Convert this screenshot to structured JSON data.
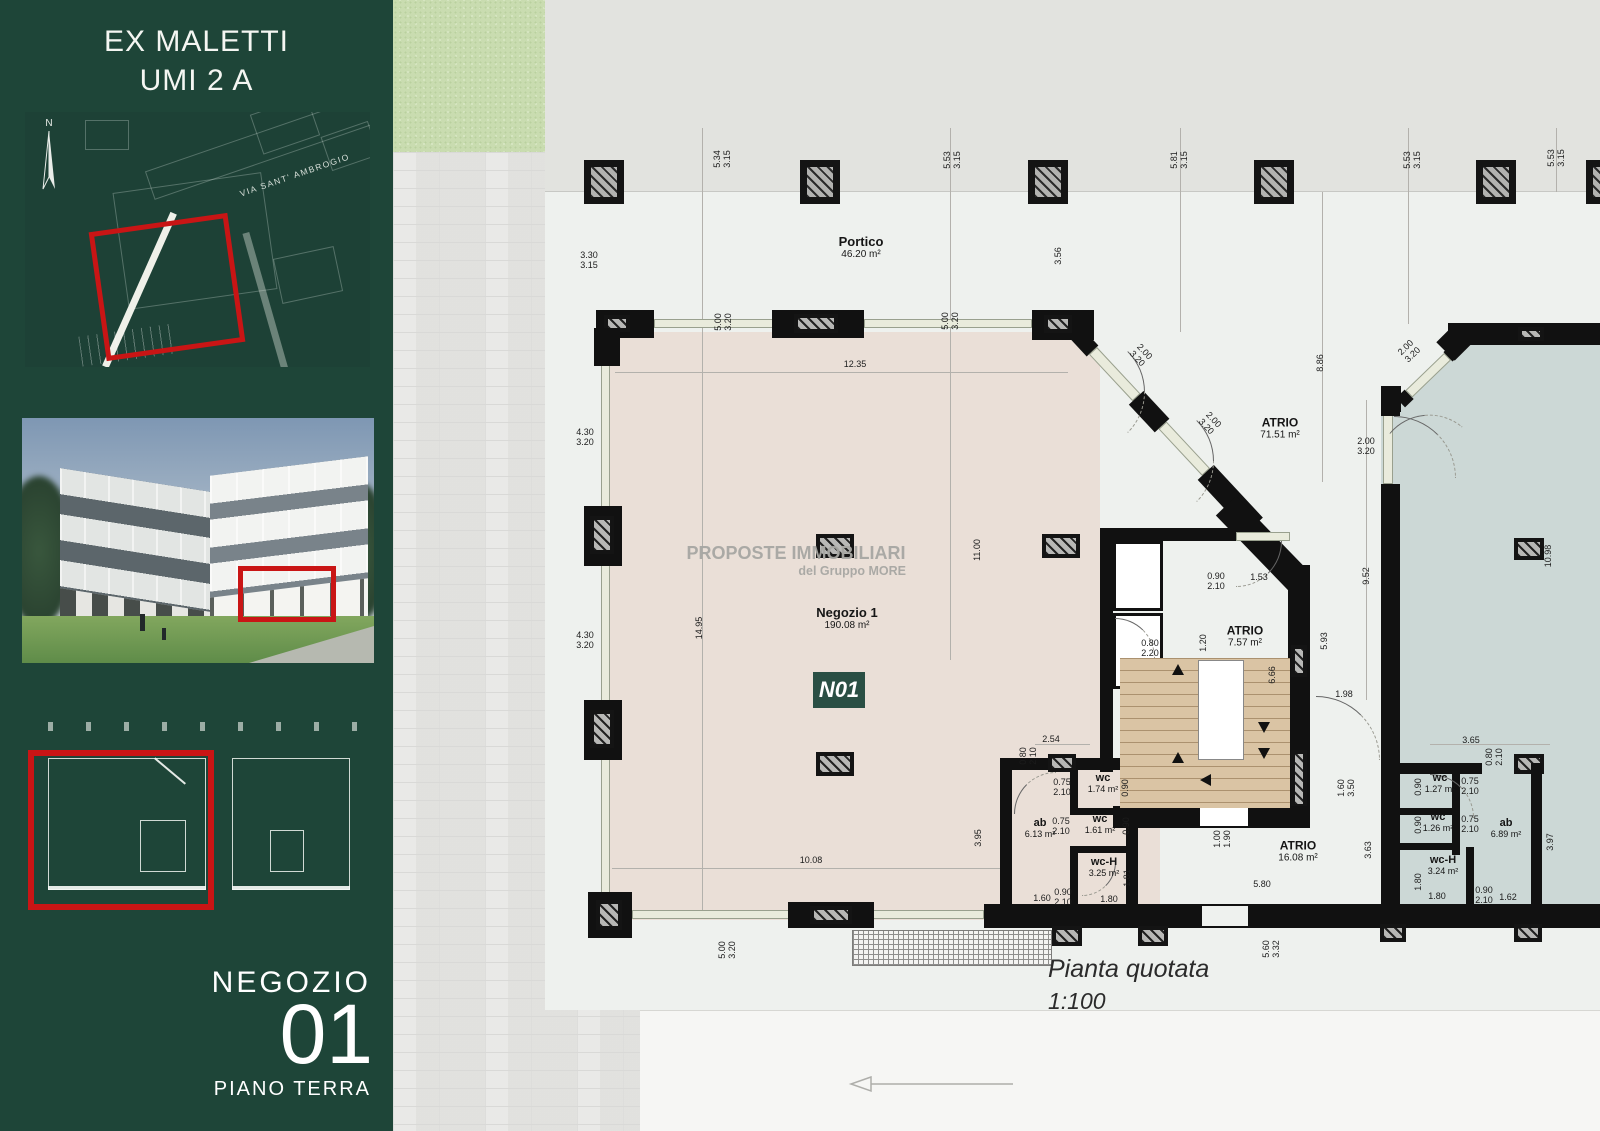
{
  "sidebar": {
    "title_line1": "EX MALETTI",
    "title_line2": "UMI 2 A",
    "compass_label": "N",
    "map_street_label": "VIA SANT' AMBROGIO",
    "unit_label": "NEGOZIO",
    "unit_number": "01",
    "floor_label": "PIANO TERRA"
  },
  "watermark": {
    "line1": "PROPOSTE IMMOBILIARI",
    "line2": "del Gruppo MORE"
  },
  "plan": {
    "unit_tag": "N01",
    "caption_title": "Pianta quotata",
    "caption_scale": "1:100",
    "room_labels": [
      {
        "name": "Portico",
        "area": "46.20 m²",
        "x": 861,
        "y": 247,
        "cls": "lg"
      },
      {
        "name": "Negozio 1",
        "area": "190.08 m²",
        "x": 847,
        "y": 618,
        "cls": "lg"
      },
      {
        "name": "ATRIO",
        "area": "71.51 m²",
        "x": 1280,
        "y": 428,
        "cls": "md"
      },
      {
        "name": "ATRIO",
        "area": "7.57 m²",
        "x": 1245,
        "y": 636,
        "cls": "md"
      },
      {
        "name": "ATRIO",
        "area": "16.08 m²",
        "x": 1298,
        "y": 851,
        "cls": "md"
      },
      {
        "name": "ab",
        "area": "6.13 m²",
        "x": 1040,
        "y": 828,
        "cls": "sm"
      },
      {
        "name": "wc",
        "area": "1.74 m²",
        "x": 1103,
        "y": 783,
        "cls": "sm"
      },
      {
        "name": "wc",
        "area": "1.61 m²",
        "x": 1100,
        "y": 824,
        "cls": "sm"
      },
      {
        "name": "wc-H",
        "area": "3.25 m²",
        "x": 1104,
        "y": 867,
        "cls": "sm"
      },
      {
        "name": "wc",
        "area": "1.27 m²",
        "x": 1440,
        "y": 783,
        "cls": "sm"
      },
      {
        "name": "wc",
        "area": "1.26 m²",
        "x": 1438,
        "y": 822,
        "cls": "sm"
      },
      {
        "name": "wc-H",
        "area": "3.24 m²",
        "x": 1443,
        "y": 865,
        "cls": "sm"
      },
      {
        "name": "ab",
        "area": "6.89 m²",
        "x": 1506,
        "y": 828,
        "cls": "sm"
      }
    ],
    "dimensions": [
      {
        "t": "5.34\n3.15",
        "x": 722,
        "y": 159,
        "r": 1
      },
      {
        "t": "5.53\n3.15",
        "x": 952,
        "y": 160,
        "r": 1
      },
      {
        "t": "5.81\n3.15",
        "x": 1179,
        "y": 160,
        "r": 1
      },
      {
        "t": "5.53\n3.15",
        "x": 1412,
        "y": 160,
        "r": 1
      },
      {
        "t": "5.53\n3.15",
        "x": 1556,
        "y": 158,
        "r": 1
      },
      {
        "t": "3.30\n3.15",
        "x": 589,
        "y": 260,
        "r": 0
      },
      {
        "t": "3.56",
        "x": 1058,
        "y": 256,
        "r": 1
      },
      {
        "t": "5.00\n3.20",
        "x": 723,
        "y": 322,
        "r": 1
      },
      {
        "t": "5.00\n3.20",
        "x": 950,
        "y": 321,
        "r": 1
      },
      {
        "t": "12.35",
        "x": 855,
        "y": 364,
        "r": 0
      },
      {
        "t": "2.00\n3.20",
        "x": 1141,
        "y": 355,
        "r": 2
      },
      {
        "t": "2.00\n3.20",
        "x": 1210,
        "y": 423,
        "r": 2
      },
      {
        "t": "8.86",
        "x": 1320,
        "y": 363,
        "r": 1
      },
      {
        "t": "2.00\n3.20",
        "x": 1409,
        "y": 351,
        "r": 3
      },
      {
        "t": "2.00\n3.20",
        "x": 1366,
        "y": 446,
        "r": 0
      },
      {
        "t": "4.30\n3.20",
        "x": 585,
        "y": 437,
        "r": 0
      },
      {
        "t": "4.30\n3.20",
        "x": 585,
        "y": 640,
        "r": 0
      },
      {
        "t": "14.95",
        "x": 699,
        "y": 628,
        "r": 1
      },
      {
        "t": "11.00",
        "x": 977,
        "y": 550,
        "r": 1
      },
      {
        "t": "9.52",
        "x": 1366,
        "y": 576,
        "r": 1
      },
      {
        "t": "10.98",
        "x": 1548,
        "y": 556,
        "r": 1
      },
      {
        "t": "0.90\n2.10",
        "x": 1216,
        "y": 581,
        "r": 0
      },
      {
        "t": "1.53",
        "x": 1259,
        "y": 577,
        "r": 0
      },
      {
        "t": "0.80\n2.20",
        "x": 1150,
        "y": 648,
        "r": 0
      },
      {
        "t": "1.20",
        "x": 1203,
        "y": 643,
        "r": 1
      },
      {
        "t": "6.66",
        "x": 1272,
        "y": 675,
        "r": 1
      },
      {
        "t": "5.93",
        "x": 1324,
        "y": 641,
        "r": 1
      },
      {
        "t": "1.98",
        "x": 1344,
        "y": 694,
        "r": 0
      },
      {
        "t": "2.54",
        "x": 1051,
        "y": 739,
        "r": 0
      },
      {
        "t": "0.80\n2.10",
        "x": 1028,
        "y": 756,
        "r": 1
      },
      {
        "t": "0.75\n2.10",
        "x": 1062,
        "y": 787,
        "r": 0
      },
      {
        "t": "0.90",
        "x": 1125,
        "y": 788,
        "r": 1
      },
      {
        "t": "0.75\n2.10",
        "x": 1061,
        "y": 826,
        "r": 0
      },
      {
        "t": "0.90",
        "x": 1126,
        "y": 826,
        "r": 1
      },
      {
        "t": "1.81",
        "x": 1127,
        "y": 878,
        "r": 1
      },
      {
        "t": "1.60",
        "x": 1042,
        "y": 898,
        "r": 0
      },
      {
        "t": "0.90\n2.10",
        "x": 1063,
        "y": 897,
        "r": 0
      },
      {
        "t": "1.80",
        "x": 1109,
        "y": 899,
        "r": 0
      },
      {
        "t": "3.95",
        "x": 978,
        "y": 838,
        "r": 1
      },
      {
        "t": "10.08",
        "x": 811,
        "y": 860,
        "r": 0
      },
      {
        "t": "5.00\n3.20",
        "x": 727,
        "y": 950,
        "r": 1
      },
      {
        "t": "1.00\n1.90",
        "x": 1222,
        "y": 839,
        "r": 1
      },
      {
        "t": "5.80",
        "x": 1262,
        "y": 884,
        "r": 0
      },
      {
        "t": "1.60\n3.50",
        "x": 1346,
        "y": 788,
        "r": 1
      },
      {
        "t": "3.63",
        "x": 1368,
        "y": 850,
        "r": 1
      },
      {
        "t": "3.65",
        "x": 1471,
        "y": 740,
        "r": 0
      },
      {
        "t": "0.80\n2.10",
        "x": 1494,
        "y": 757,
        "r": 1
      },
      {
        "t": "0.90",
        "x": 1418,
        "y": 787,
        "r": 1
      },
      {
        "t": "0.75\n2.10",
        "x": 1470,
        "y": 786,
        "r": 0
      },
      {
        "t": "0.90",
        "x": 1418,
        "y": 825,
        "r": 1
      },
      {
        "t": "0.75\n2.10",
        "x": 1470,
        "y": 824,
        "r": 0
      },
      {
        "t": "1.80",
        "x": 1418,
        "y": 882,
        "r": 1
      },
      {
        "t": "1.80",
        "x": 1437,
        "y": 896,
        "r": 0
      },
      {
        "t": "0.90\n2.10",
        "x": 1484,
        "y": 895,
        "r": 0
      },
      {
        "t": "1.62",
        "x": 1508,
        "y": 897,
        "r": 0
      },
      {
        "t": "3.97",
        "x": 1550,
        "y": 842,
        "r": 1
      },
      {
        "t": "5.60\n3.32",
        "x": 1271,
        "y": 949,
        "r": 1
      }
    ]
  },
  "colors": {
    "sidebar_green": "#1e4538",
    "accent_red": "#c91515",
    "negozio_floor": "#eadfd7",
    "adjacent_floor": "#ccd8d6",
    "stairs_floor": "#dac4a4",
    "tag_green": "#2a4f44"
  }
}
